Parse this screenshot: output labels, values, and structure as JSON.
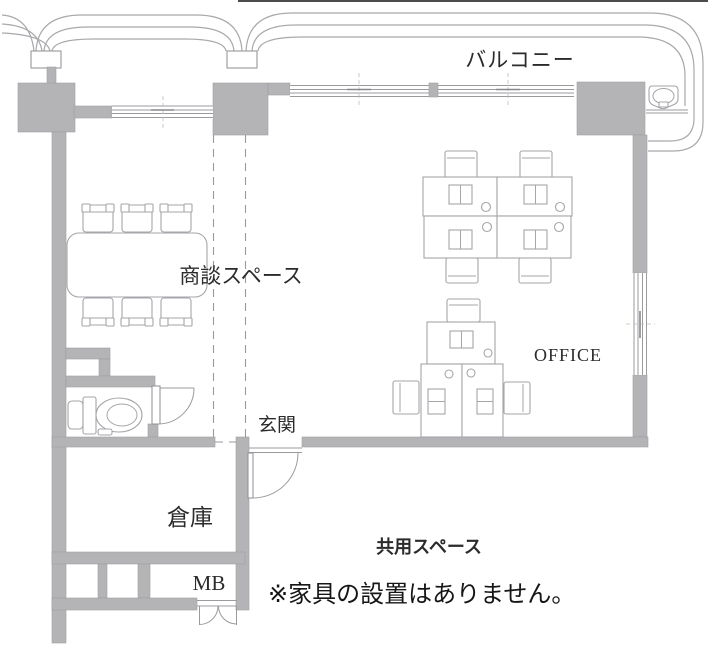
{
  "plan": {
    "areas": {
      "balcony": {
        "label": "バルコニー"
      },
      "meeting_space": {
        "label": "商談スペース"
      },
      "office": {
        "label": "OFFICE"
      },
      "entrance": {
        "label": "玄関"
      },
      "storage": {
        "label": "倉庫"
      },
      "meter_box": {
        "label": "MB"
      },
      "common_space": {
        "label": "共用スペース"
      }
    },
    "note": "※家具の設置はありません。",
    "furniture": {
      "meeting_chairs_count": 6,
      "office_desks_count": 7,
      "icons": [
        "toilet-icon",
        "sink-icon",
        "meeting-table",
        "desk",
        "chair",
        "door-swing"
      ]
    },
    "colors": {
      "wall": "#b4b4b7",
      "outline": "#9b9b9f",
      "furniture_outline": "#a6a6aa",
      "label_text": "#2b2b2b",
      "note_text": "#161616",
      "background": "#ffffff"
    }
  }
}
